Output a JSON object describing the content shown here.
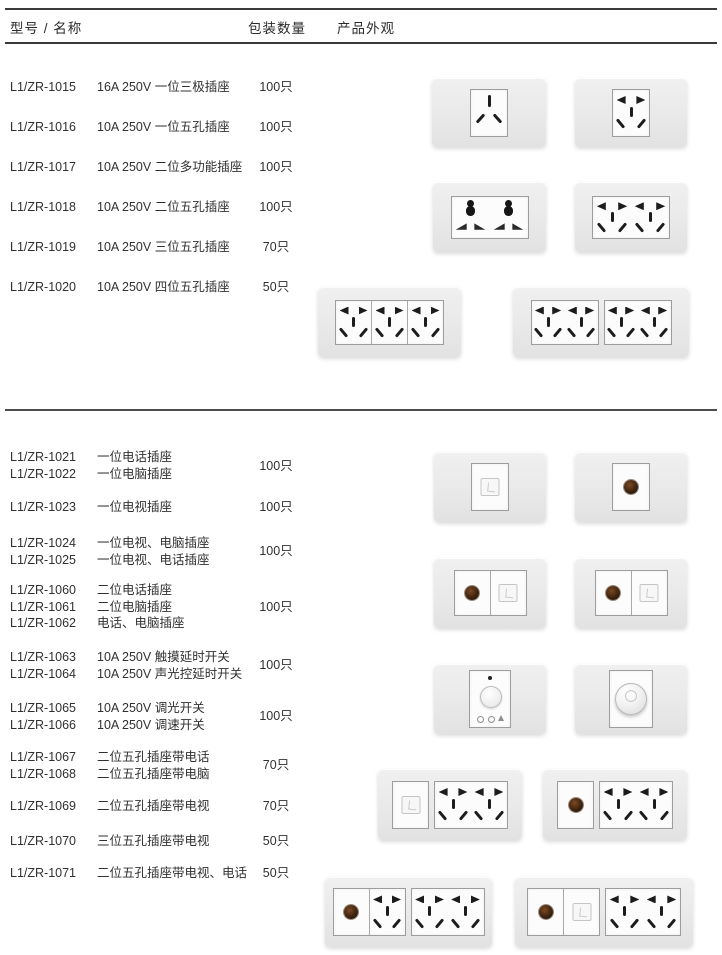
{
  "page": {
    "header": {
      "model_name": "型号 / 名称",
      "qty": "包装数量",
      "appearance": "产品外观"
    }
  },
  "section1": {
    "rows": [
      {
        "model": "L1/ZR-1015",
        "name": "16A 250V 一位三极插座",
        "qty": "100只"
      },
      {
        "model": "L1/ZR-1016",
        "name": "10A 250V 一位五孔插座",
        "qty": "100只"
      },
      {
        "model": "L1/ZR-1017",
        "name": "10A 250V 二位多功能插座",
        "qty": "100只"
      },
      {
        "model": "L1/ZR-1018",
        "name": "10A 250V 二位五孔插座",
        "qty": "100只"
      },
      {
        "model": "L1/ZR-1019",
        "name": "10A 250V 三位五孔插座",
        "qty": "70只"
      },
      {
        "model": "L1/ZR-1020",
        "name": "10A 250V 四位五孔插座",
        "qty": "50只"
      }
    ]
  },
  "section2": {
    "groups": [
      {
        "lines": [
          {
            "model": "L1/ZR-1021",
            "name": "一位电话插座"
          },
          {
            "model": "L1/ZR-1022",
            "name": "一位电脑插座"
          }
        ],
        "qty": "100只"
      },
      {
        "lines": [
          {
            "model": "L1/ZR-1023",
            "name": "一位电视插座"
          }
        ],
        "qty": "100只"
      },
      {
        "lines": [
          {
            "model": "L1/ZR-1024",
            "name": "一位电视、电脑插座"
          },
          {
            "model": "L1/ZR-1025",
            "name": "一位电视、电话插座"
          }
        ],
        "qty": "100只"
      },
      {
        "lines": [
          {
            "model": "L1/ZR-1060",
            "name": "二位电话插座"
          },
          {
            "model": "L1/ZR-1061",
            "name": "二位电脑插座"
          },
          {
            "model": "L1/ZR-1062",
            "name": "电话、电脑插座"
          }
        ],
        "qty": "100只"
      },
      {
        "lines": [
          {
            "model": "L1/ZR-1063",
            "name": "10A 250V 触摸延时开关"
          },
          {
            "model": "L1/ZR-1064",
            "name": "10A 250V 声光控延时开关"
          }
        ],
        "qty": "100只"
      },
      {
        "lines": [
          {
            "model": "L1/ZR-1065",
            "name": "10A 250V 调光开关"
          },
          {
            "model": "L1/ZR-1066",
            "name": "10A 250V 调速开关"
          }
        ],
        "qty": "100只"
      },
      {
        "lines": [
          {
            "model": "L1/ZR-1067",
            "name": "二位五孔插座带电话"
          },
          {
            "model": "L1/ZR-1068",
            "name": "二位五孔插座带电脑"
          }
        ],
        "qty": "70只"
      },
      {
        "lines": [
          {
            "model": "L1/ZR-1069",
            "name": "二位五孔插座带电视"
          }
        ],
        "qty": "70只"
      },
      {
        "lines": [
          {
            "model": "L1/ZR-1070",
            "name": "三位五孔插座带电视"
          }
        ],
        "qty": "50只"
      },
      {
        "lines": [
          {
            "model": "L1/ZR-1071",
            "name": "二位五孔插座带电视、电话"
          }
        ],
        "qty": "50只"
      }
    ]
  },
  "plates": [
    {
      "name": "socket-3pin-1gang",
      "x": 432,
      "y": 78,
      "w": 114,
      "h": 69,
      "groups": [
        {
          "cells": [
            "three"
          ],
          "cw": 36,
          "ch": 46
        }
      ]
    },
    {
      "name": "socket-5hole-1gang",
      "x": 575,
      "y": 78,
      "w": 112,
      "h": 69,
      "groups": [
        {
          "cells": [
            "five"
          ],
          "cw": 36,
          "ch": 46
        }
      ]
    },
    {
      "name": "socket-universal-2gang",
      "x": 433,
      "y": 182,
      "w": 113,
      "h": 70,
      "groups": [
        {
          "cells": [
            "uni",
            "uni"
          ],
          "cw": 38,
          "ch": 41
        }
      ]
    },
    {
      "name": "socket-5hole-2gang",
      "x": 575,
      "y": 182,
      "w": 112,
      "h": 70,
      "groups": [
        {
          "cells": [
            "five",
            "five"
          ],
          "cw": 38,
          "ch": 41
        }
      ]
    },
    {
      "name": "socket-5hole-3gang",
      "x": 318,
      "y": 287,
      "w": 143,
      "h": 70,
      "groups": [
        {
          "cells": [
            "five",
            "five",
            "five"
          ],
          "div": true,
          "cw": 35,
          "ch": 43
        }
      ]
    },
    {
      "name": "socket-5hole-4gang",
      "x": 513,
      "y": 287,
      "w": 176,
      "h": 70,
      "groups": [
        {
          "cells": [
            "five",
            "five"
          ],
          "cw": 33,
          "ch": 43
        },
        {
          "cells": [
            "five",
            "five"
          ],
          "cw": 33,
          "ch": 43
        }
      ]
    },
    {
      "name": "jack-1gang",
      "x": 434,
      "y": 452,
      "w": 112,
      "h": 70,
      "groups": [
        {
          "cells": [
            "jack"
          ],
          "cw": 36,
          "ch": 46
        }
      ]
    },
    {
      "name": "tv-1gang",
      "x": 575,
      "y": 452,
      "w": 112,
      "h": 70,
      "groups": [
        {
          "cells": [
            "tv"
          ],
          "cw": 36,
          "ch": 46
        }
      ]
    },
    {
      "name": "tv-jack-left",
      "x": 434,
      "y": 558,
      "w": 112,
      "h": 70,
      "groups": [
        {
          "cells": [
            "tv",
            "jack"
          ],
          "div": true,
          "cw": 35,
          "ch": 44
        }
      ]
    },
    {
      "name": "tv-jack-right",
      "x": 575,
      "y": 558,
      "w": 112,
      "h": 70,
      "groups": [
        {
          "cells": [
            "tv",
            "jack"
          ],
          "div": true,
          "cw": 35,
          "ch": 44
        }
      ]
    },
    {
      "name": "touch-delay-switch",
      "x": 434,
      "y": 664,
      "w": 112,
      "h": 70,
      "groups": [
        {
          "cells": [
            "touch"
          ],
          "cw": 40,
          "ch": 56
        }
      ]
    },
    {
      "name": "rotary-dimmer-switch",
      "x": 575,
      "y": 664,
      "w": 112,
      "h": 70,
      "groups": [
        {
          "cells": [
            "knob"
          ],
          "cw": 42,
          "ch": 56
        }
      ]
    },
    {
      "name": "jack-plus-2x5hole",
      "x": 378,
      "y": 769,
      "w": 144,
      "h": 71,
      "groups": [
        {
          "cells": [
            "jack"
          ],
          "cw": 35,
          "ch": 46
        },
        {
          "cells": [
            "five",
            "five"
          ],
          "cw": 36,
          "ch": 46
        }
      ]
    },
    {
      "name": "tv-plus-2x5hole",
      "x": 543,
      "y": 769,
      "w": 144,
      "h": 71,
      "groups": [
        {
          "cells": [
            "tv"
          ],
          "cw": 35,
          "ch": 46
        },
        {
          "cells": [
            "five",
            "five"
          ],
          "cw": 36,
          "ch": 46
        }
      ]
    },
    {
      "name": "tv-plus-3x5hole",
      "x": 325,
      "y": 877,
      "w": 167,
      "h": 70,
      "groups": [
        {
          "cells": [
            "tv",
            "five"
          ],
          "div": true,
          "cw": 35,
          "ch": 46
        },
        {
          "cells": [
            "five",
            "five"
          ],
          "cw": 36,
          "ch": 46
        }
      ]
    },
    {
      "name": "tv-jack-plus-2x5hole",
      "x": 515,
      "y": 877,
      "w": 178,
      "h": 70,
      "groups": [
        {
          "cells": [
            "tv",
            "jack"
          ],
          "div": true,
          "cw": 35,
          "ch": 46
        },
        {
          "cells": [
            "five",
            "five"
          ],
          "cw": 37,
          "ch": 46
        }
      ]
    }
  ],
  "colors": {
    "plate_bg": "#ebebeb",
    "module_border": "#9d9d9d",
    "hole": "#1c1c1c",
    "tv_hole": "#4a2a12",
    "rule": "#3a3a3a",
    "text": "#303030"
  }
}
